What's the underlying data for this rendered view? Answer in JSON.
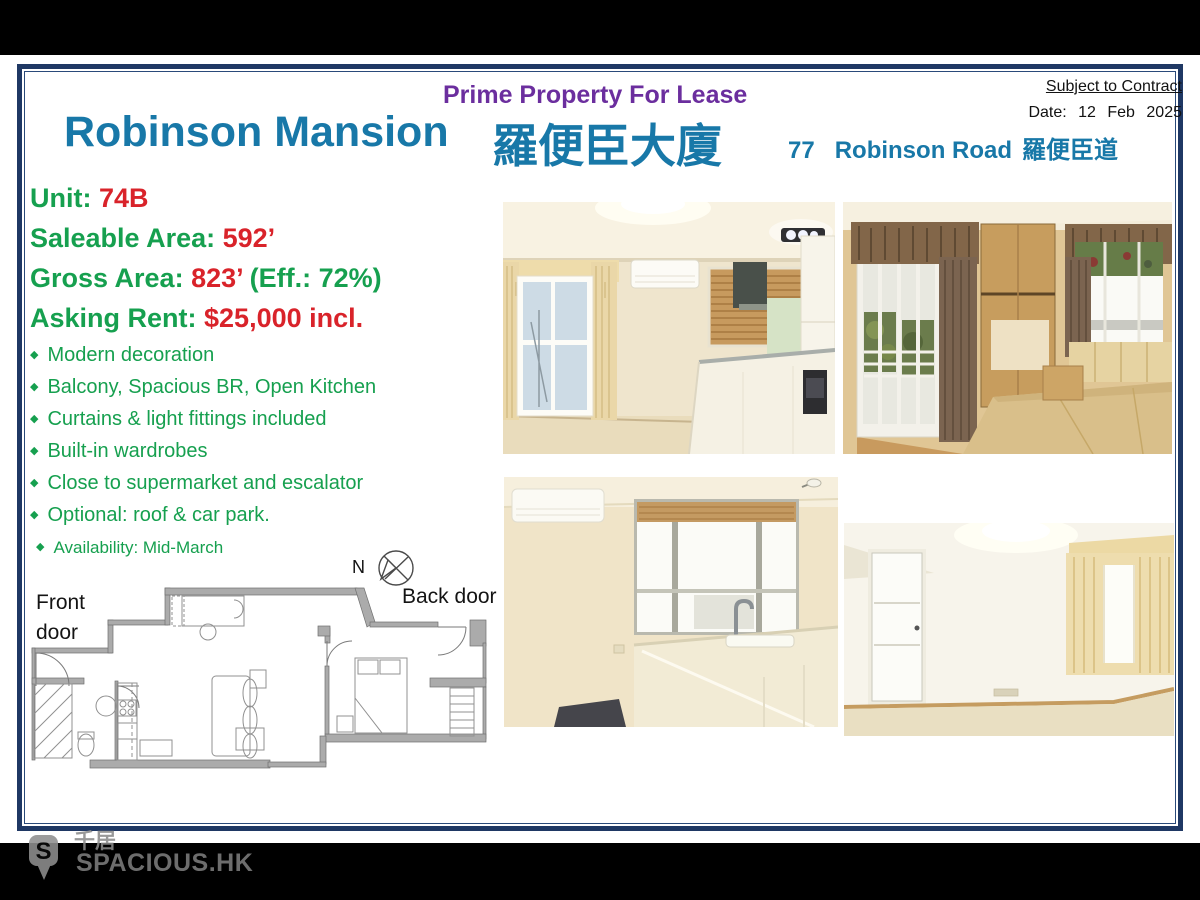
{
  "header": {
    "tagline": "Prime Property For Lease",
    "title_en": "Robinson Mansion",
    "title_zh": "羅便臣大廈",
    "address_number": "77",
    "address_road": "Robinson Road",
    "address_zh": "羅便臣道",
    "subject_to_contract": "Subject to Contract",
    "date_line": "Date: 12 Feb 2025"
  },
  "details": [
    {
      "label": "Unit: ",
      "value": "74B",
      "suffix": ""
    },
    {
      "label": "Saleable Area: ",
      "value": "592’",
      "suffix": ""
    },
    {
      "label": "Gross Area: ",
      "value": "823’",
      "suffix": " (Eff.: 72%)"
    },
    {
      "label": "Asking Rent: ",
      "value": "$25,000 incl.",
      "suffix": ""
    }
  ],
  "features": [
    "Modern decoration",
    "Balcony, Spacious BR, Open Kitchen",
    "Curtains & light fittings included",
    "Built-in wardrobes",
    "Close to supermarket and escalator",
    "Optional: roof & car park.",
    "Availability: Mid-March"
  ],
  "floorplan": {
    "front_door_line1": "Front",
    "front_door_line2": "door",
    "compass_label": "N",
    "back_door_label": "Back door"
  },
  "watermark": {
    "brand_zh": "千居",
    "brand_en": "SPACIOUS.HK",
    "pin_letter": "S"
  },
  "icons": {
    "diamond_bullet": "◆"
  },
  "colors": {
    "frame_navy": "#1f3864",
    "accent_teal": "#1878a8",
    "accent_purple": "#6b2e9e",
    "label_green": "#16a04f",
    "value_red": "#d9232a"
  }
}
